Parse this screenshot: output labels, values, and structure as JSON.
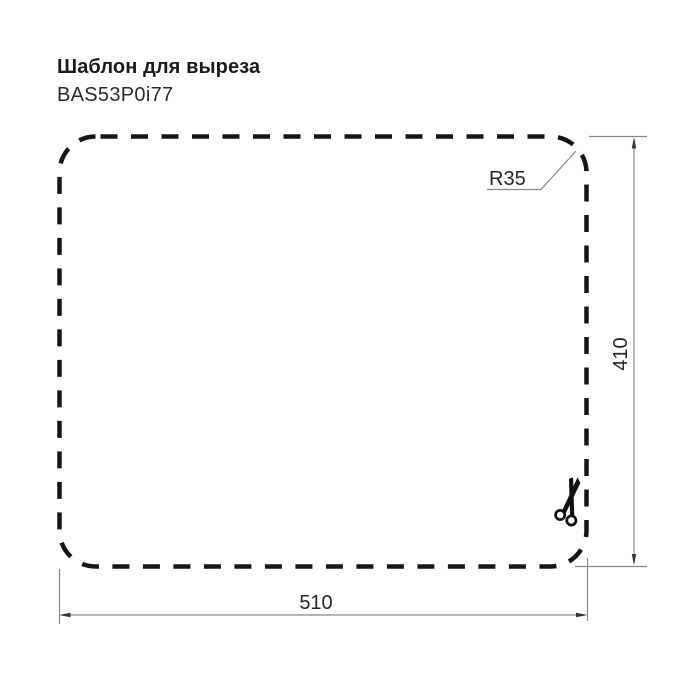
{
  "header": {
    "title": "Шаблон для выреза",
    "model": "BAS53P0i77"
  },
  "drawing": {
    "type": "cutout-template",
    "outline_style": "dashed-rounded-rectangle",
    "labels": {
      "width": "510",
      "height": "410",
      "radius": "R35"
    },
    "dimensions": {
      "width_mm": 510,
      "height_mm": 410,
      "corner_radius_mm": 35
    },
    "icons": [
      {
        "name": "scissors-icon",
        "meaning": "cut along dashed outline"
      }
    ],
    "colors": {
      "outline": "#161616",
      "dimension_line": "#8a8a8a",
      "arrowhead": "#333333",
      "text": "#262626",
      "background": "#ffffff"
    }
  }
}
